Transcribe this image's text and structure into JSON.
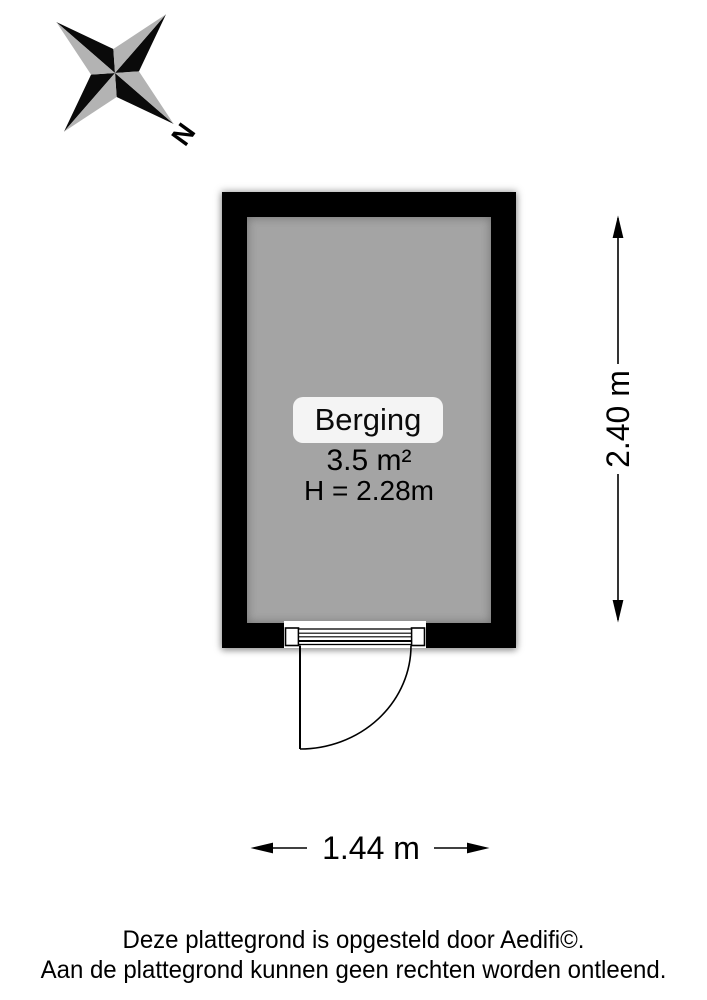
{
  "compass": {
    "north_label": "N"
  },
  "room": {
    "name": "Berging",
    "area": "3.5 m²",
    "ceiling_height": "H = 2.28m"
  },
  "dimensions": {
    "height": "2.40 m",
    "width": "1.44 m"
  },
  "footer": {
    "line1": "Deze plattegrond is opgesteld door Aedifi©.",
    "line2": "Aan de plattegrond kunnen geen rechten worden ontleend."
  },
  "colors": {
    "wall": "#000000",
    "floor": "#a4a4a4",
    "compass_gray": "#b3b3b3",
    "room_label_bg": "#f4f4f4",
    "background": "#ffffff"
  }
}
